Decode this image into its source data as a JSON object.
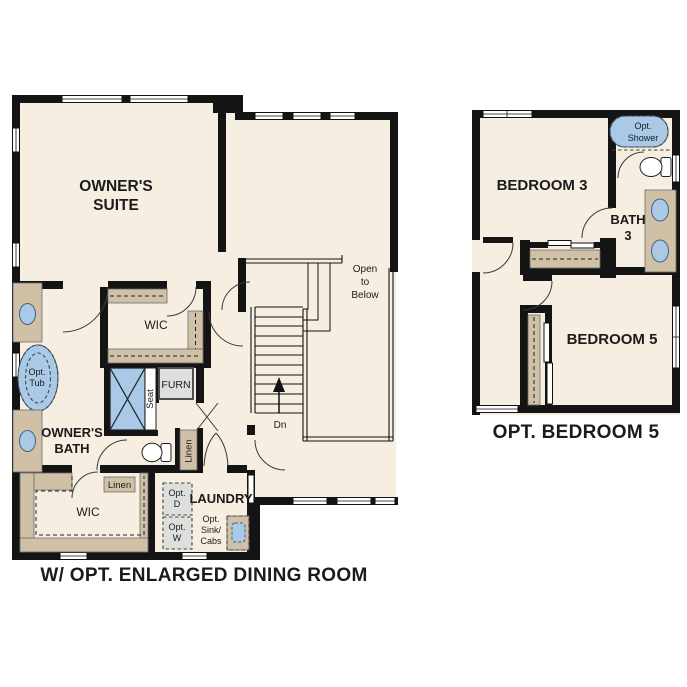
{
  "colors": {
    "floor": "#f6eee1",
    "cabinet": "#cfc0a6",
    "fixture_blue": "#a9c9e6",
    "wall": "#141414",
    "gray_box": "#dcdfdb"
  },
  "main_plan": {
    "caption": "W/ OPT. ENLARGED DINING ROOM",
    "owners_suite": [
      "OWNER'S",
      "SUITE"
    ],
    "owners_bath": [
      "OWNER'S",
      "BATH"
    ],
    "wic_upper": "WIC",
    "wic_lower": "WIC",
    "laundry": "LAUNDRY",
    "furnace": "FURN",
    "seat": "Seat",
    "linen_closet": "Linen",
    "linen_cabinet": "Linen",
    "opt_tub": [
      "Opt.",
      "Tub"
    ],
    "opt_dryer": [
      "Opt.",
      "D"
    ],
    "opt_washer": [
      "Opt.",
      "W"
    ],
    "opt_sink_cabs": [
      "Opt.",
      "Sink/",
      "Cabs"
    ],
    "open_to_below": [
      "Open",
      "to",
      "Below"
    ],
    "stair_direction": "Dn"
  },
  "optional_plan": {
    "caption": "OPT. BEDROOM 5",
    "bedroom3": "BEDROOM 3",
    "bath3": [
      "BATH",
      "3"
    ],
    "bedroom5": "BEDROOM 5",
    "opt_shower": [
      "Opt.",
      "Shower"
    ]
  }
}
